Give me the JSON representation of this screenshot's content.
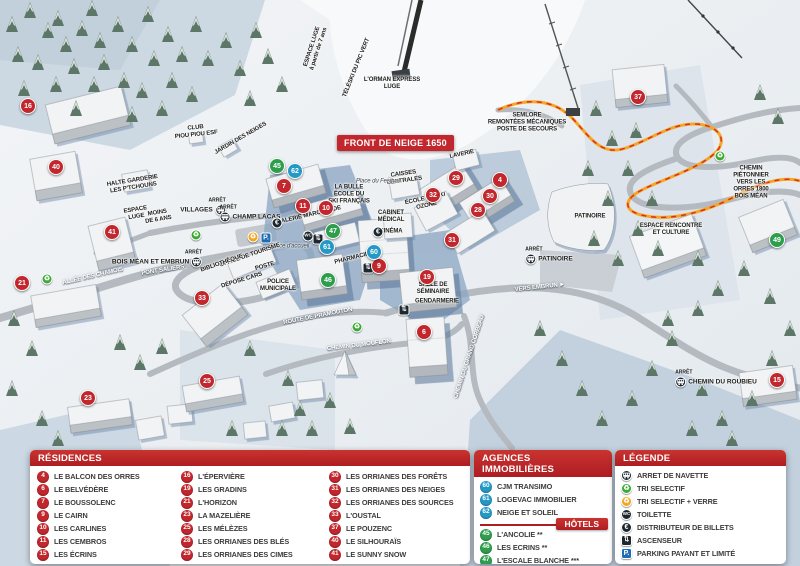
{
  "banner": "FRONT DE NEIGE 1650",
  "colors": {
    "marker_red": "#c1272d",
    "marker_blue": "#2599c6",
    "marker_green": "#2d9e4c",
    "header_red": "#af1d22",
    "parking_blue": "#1f6cb5",
    "recycle_green": "#3aaa35",
    "recycle_yellow": "#f3a61b",
    "icon_dark": "#1d2730"
  },
  "panels": {
    "residences": {
      "title": "RÉSIDENCES",
      "columns": [
        [
          {
            "n": "4",
            "label": "LE BALCON DES ORRES"
          },
          {
            "n": "6",
            "label": "LE BELVÉDÈRE"
          },
          {
            "n": "7",
            "label": "LE BOUSSOLENC"
          },
          {
            "n": "9",
            "label": "LE CAIRN"
          },
          {
            "n": "10",
            "label": "LES CARLINES"
          },
          {
            "n": "11",
            "label": "LES CEMBROS"
          },
          {
            "n": "15",
            "label": "LES ÉCRINS"
          }
        ],
        [
          {
            "n": "16",
            "label": "L'ÉPERVIÈRE"
          },
          {
            "n": "19",
            "label": "LES GRADINS"
          },
          {
            "n": "21",
            "label": "L'HORIZON"
          },
          {
            "n": "23",
            "label": "LA MAZELIÈRE"
          },
          {
            "n": "25",
            "label": "LES MÉLÈZES"
          },
          {
            "n": "28",
            "label": "LES ORRIANES DES BLÉS"
          },
          {
            "n": "29",
            "label": "LES ORRIANES DES CIMES"
          }
        ],
        [
          {
            "n": "30",
            "label": "LES ORRIANES DES FORÊTS"
          },
          {
            "n": "31",
            "label": "LES ORRIANES DES NEIGES"
          },
          {
            "n": "32",
            "label": "LES ORRIANES DES SOURCES"
          },
          {
            "n": "33",
            "label": "L'OUSTAL"
          },
          {
            "n": "37",
            "label": "LE POUZENC"
          },
          {
            "n": "40",
            "label": "LE SILHOURAÏS"
          },
          {
            "n": "41",
            "label": "LE SUNNY SNOW"
          }
        ]
      ]
    },
    "agences": {
      "title": "AGENCES IMMOBILIÈRES",
      "items": [
        {
          "n": "60",
          "label": "CJM TRANSIMO"
        },
        {
          "n": "61",
          "label": "LOGEVAC IMMOBILIER"
        },
        {
          "n": "62",
          "label": "NEIGE ET SOLEIL"
        }
      ]
    },
    "hotels": {
      "title": "HÔTELS",
      "items": [
        {
          "n": "45",
          "label": "L'ANCOLIE **"
        },
        {
          "n": "46",
          "label": "LES ECRINS **"
        },
        {
          "n": "47",
          "label": "L'ESCALE BLANCHE ***"
        },
        {
          "n": "49",
          "label": "LES TRAPPEURS **"
        }
      ]
    },
    "legende": {
      "title": "LÉGENDE",
      "items": [
        {
          "icon": "bus",
          "label": "ARRET DE NAVETTE"
        },
        {
          "icon": "recycle-green",
          "label": "TRI SELECTIF"
        },
        {
          "icon": "recycle-yellow",
          "label": "TRI SELECTIF + VERRE"
        },
        {
          "icon": "wc",
          "label": "TOILETTE"
        },
        {
          "icon": "euro",
          "label": "DISTRIBUTEUR DE BILLETS"
        },
        {
          "icon": "elevator",
          "label": "ASCENSEUR"
        },
        {
          "icon": "parking",
          "label": "PARKING PAYANT ET LIMITÉ"
        }
      ]
    }
  },
  "map": {
    "stop_prefix": "ARRÊT",
    "markers": [
      {
        "n": "16",
        "c": "red",
        "x": 28,
        "y": 106
      },
      {
        "n": "40",
        "c": "red",
        "x": 56,
        "y": 167
      },
      {
        "n": "41",
        "c": "red",
        "x": 112,
        "y": 232
      },
      {
        "n": "21",
        "c": "red",
        "x": 22,
        "y": 283
      },
      {
        "n": "33",
        "c": "red",
        "x": 202,
        "y": 298
      },
      {
        "n": "23",
        "c": "red",
        "x": 88,
        "y": 398
      },
      {
        "n": "25",
        "c": "red",
        "x": 207,
        "y": 381
      },
      {
        "n": "7",
        "c": "red",
        "x": 284,
        "y": 186
      },
      {
        "n": "11",
        "c": "red",
        "x": 303,
        "y": 206
      },
      {
        "n": "10",
        "c": "red",
        "x": 326,
        "y": 208
      },
      {
        "n": "9",
        "c": "red",
        "x": 379,
        "y": 266
      },
      {
        "n": "19",
        "c": "red",
        "x": 427,
        "y": 277
      },
      {
        "n": "6",
        "c": "red",
        "x": 424,
        "y": 332
      },
      {
        "n": "29",
        "c": "red",
        "x": 456,
        "y": 178
      },
      {
        "n": "32",
        "c": "red",
        "x": 433,
        "y": 195
      },
      {
        "n": "4",
        "c": "red",
        "x": 500,
        "y": 180
      },
      {
        "n": "30",
        "c": "red",
        "x": 490,
        "y": 196
      },
      {
        "n": "28",
        "c": "red",
        "x": 478,
        "y": 210
      },
      {
        "n": "31",
        "c": "red",
        "x": 452,
        "y": 240
      },
      {
        "n": "37",
        "c": "red",
        "x": 638,
        "y": 97
      },
      {
        "n": "15",
        "c": "red",
        "x": 777,
        "y": 380
      },
      {
        "n": "62",
        "c": "blue",
        "x": 295,
        "y": 171
      },
      {
        "n": "61",
        "c": "blue",
        "x": 327,
        "y": 247
      },
      {
        "n": "60",
        "c": "blue",
        "x": 374,
        "y": 252
      },
      {
        "n": "45",
        "c": "green",
        "x": 277,
        "y": 166
      },
      {
        "n": "47",
        "c": "green",
        "x": 333,
        "y": 231
      },
      {
        "n": "46",
        "c": "green",
        "x": 328,
        "y": 280
      },
      {
        "n": "49",
        "c": "green",
        "x": 777,
        "y": 240
      }
    ],
    "labels": [
      {
        "t": "ESPACE LUGE\nà partir de 7 ans",
        "x": 316,
        "y": 48,
        "r": -72
      },
      {
        "t": "TÉLÉSKI DU PIC VERT",
        "x": 357,
        "y": 68,
        "r": -68
      },
      {
        "t": "L'ORMAN EXPRESS\nLUGE",
        "x": 392,
        "y": 84,
        "r": 0
      },
      {
        "t": "CLUB\nPIOU PIOU ESF",
        "x": 196,
        "y": 132,
        "r": -6
      },
      {
        "t": "JARDIN DES NEIGES",
        "x": 241,
        "y": 139,
        "r": -30
      },
      {
        "t": "HALTE GARDERIE\nLES P'TCHOUNS",
        "x": 133,
        "y": 185,
        "r": -9
      },
      {
        "t": "ESPACE\nLUGE",
        "x": 136,
        "y": 214,
        "r": -9
      },
      {
        "t": "MOINS\nDE 6 ANS",
        "x": 158,
        "y": 217,
        "r": -9
      },
      {
        "t": "SEMLORE\nREMONTÉES MÉCANIQUES\nPOSTE DE SECOURS",
        "x": 527,
        "y": 123,
        "r": 0
      },
      {
        "t": "LAVERIE",
        "x": 462,
        "y": 155,
        "r": -12
      },
      {
        "t": "CAISSES\nCENTRALES",
        "x": 404,
        "y": 178,
        "r": -8
      },
      {
        "t": "ÉCOLE DE SKI\nOZONE",
        "x": 426,
        "y": 203,
        "r": -12
      },
      {
        "t": "LA BULLE\nÉCOLE DU\nSKI FRANÇAIS",
        "x": 349,
        "y": 195,
        "r": 0
      },
      {
        "t": "Place du Festival",
        "x": 378,
        "y": 182,
        "r": 0,
        "cls": "it"
      },
      {
        "t": "GALERIE MARCHANDE",
        "x": 309,
        "y": 216,
        "r": -13
      },
      {
        "t": "CABINET\nMÉDICAL",
        "x": 391,
        "y": 217,
        "r": 0
      },
      {
        "t": "CINÉMA",
        "x": 391,
        "y": 232,
        "r": 0
      },
      {
        "t": "PHARMACIE",
        "x": 352,
        "y": 259,
        "r": -14
      },
      {
        "t": "Place d'accueil",
        "x": 290,
        "y": 247,
        "r": 0,
        "cls": "it"
      },
      {
        "t": "OFFICE DE TOURISME",
        "x": 250,
        "y": 256,
        "r": -19
      },
      {
        "t": "BIBLIOTHÈQUE",
        "x": 222,
        "y": 264,
        "r": -19
      },
      {
        "t": "POSTE",
        "x": 265,
        "y": 267,
        "r": -16
      },
      {
        "t": "DÉPOSE CARS",
        "x": 242,
        "y": 281,
        "r": -17
      },
      {
        "t": "POLICE\nMUNICIPALE",
        "x": 278,
        "y": 286,
        "r": 0
      },
      {
        "t": "SALLE DE\nSÉMINAIRE",
        "x": 433,
        "y": 289,
        "r": 0
      },
      {
        "t": "GENDARMERIE",
        "x": 437,
        "y": 302,
        "r": 0
      },
      {
        "t": "PATINOIRE",
        "x": 590,
        "y": 217,
        "r": 0
      },
      {
        "t": "ESPACE RENCONTRE\nET CULTURE",
        "x": 671,
        "y": 230,
        "r": 0
      },
      {
        "t": "CHEMIN PIÉTONNIER\nVERS LES ORRES 1800\nBOIS MÉAN",
        "x": 751,
        "y": 183,
        "r": 0
      },
      {
        "t": "ALLÉE DES CHAMOIS",
        "x": 93,
        "y": 277,
        "r": -13,
        "cls": "road"
      },
      {
        "t": "PONT SALIERS",
        "x": 163,
        "y": 271,
        "r": -9,
        "cls": "road"
      },
      {
        "t": "ROUTE DE PRAMOUTON",
        "x": 318,
        "y": 317,
        "r": -11,
        "cls": "road"
      },
      {
        "t": "CHEMIN DU MOUFLON",
        "x": 359,
        "y": 346,
        "r": -7,
        "cls": "road"
      },
      {
        "t": "CHEMIN DU GRAND CORBEAU",
        "x": 470,
        "y": 357,
        "r": -72,
        "cls": "road"
      },
      {
        "t": "VERS EMBRUN ►",
        "x": 540,
        "y": 288,
        "r": -6,
        "cls": "road"
      }
    ],
    "stops": [
      {
        "label": "VILLAGES",
        "x": 203,
        "y": 207,
        "side": "l"
      },
      {
        "label": "CHAMP LACAS",
        "x": 250,
        "y": 214,
        "side": "r"
      },
      {
        "label": "BOIS MÉAN ET EMBRUN",
        "x": 157,
        "y": 259,
        "side": "l"
      },
      {
        "label": "PATINOIRE",
        "x": 549,
        "y": 256,
        "side": "r"
      },
      {
        "label": "CHEMIN DU ROUBIEU",
        "x": 716,
        "y": 379,
        "side": "r"
      }
    ],
    "icons": [
      {
        "t": "rg",
        "x": 196,
        "y": 235
      },
      {
        "t": "rg",
        "x": 47,
        "y": 279
      },
      {
        "t": "rg",
        "x": 357,
        "y": 327
      },
      {
        "t": "rg",
        "x": 720,
        "y": 156
      },
      {
        "t": "ry",
        "x": 253,
        "y": 237
      },
      {
        "t": "p",
        "x": 266,
        "y": 238
      },
      {
        "t": "eu",
        "x": 277,
        "y": 223
      },
      {
        "t": "eu",
        "x": 378,
        "y": 232
      },
      {
        "t": "wc",
        "x": 308,
        "y": 236
      },
      {
        "t": "asc",
        "x": 318,
        "y": 239
      },
      {
        "t": "asc",
        "x": 368,
        "y": 268
      },
      {
        "t": "asc",
        "x": 404,
        "y": 310
      }
    ]
  }
}
